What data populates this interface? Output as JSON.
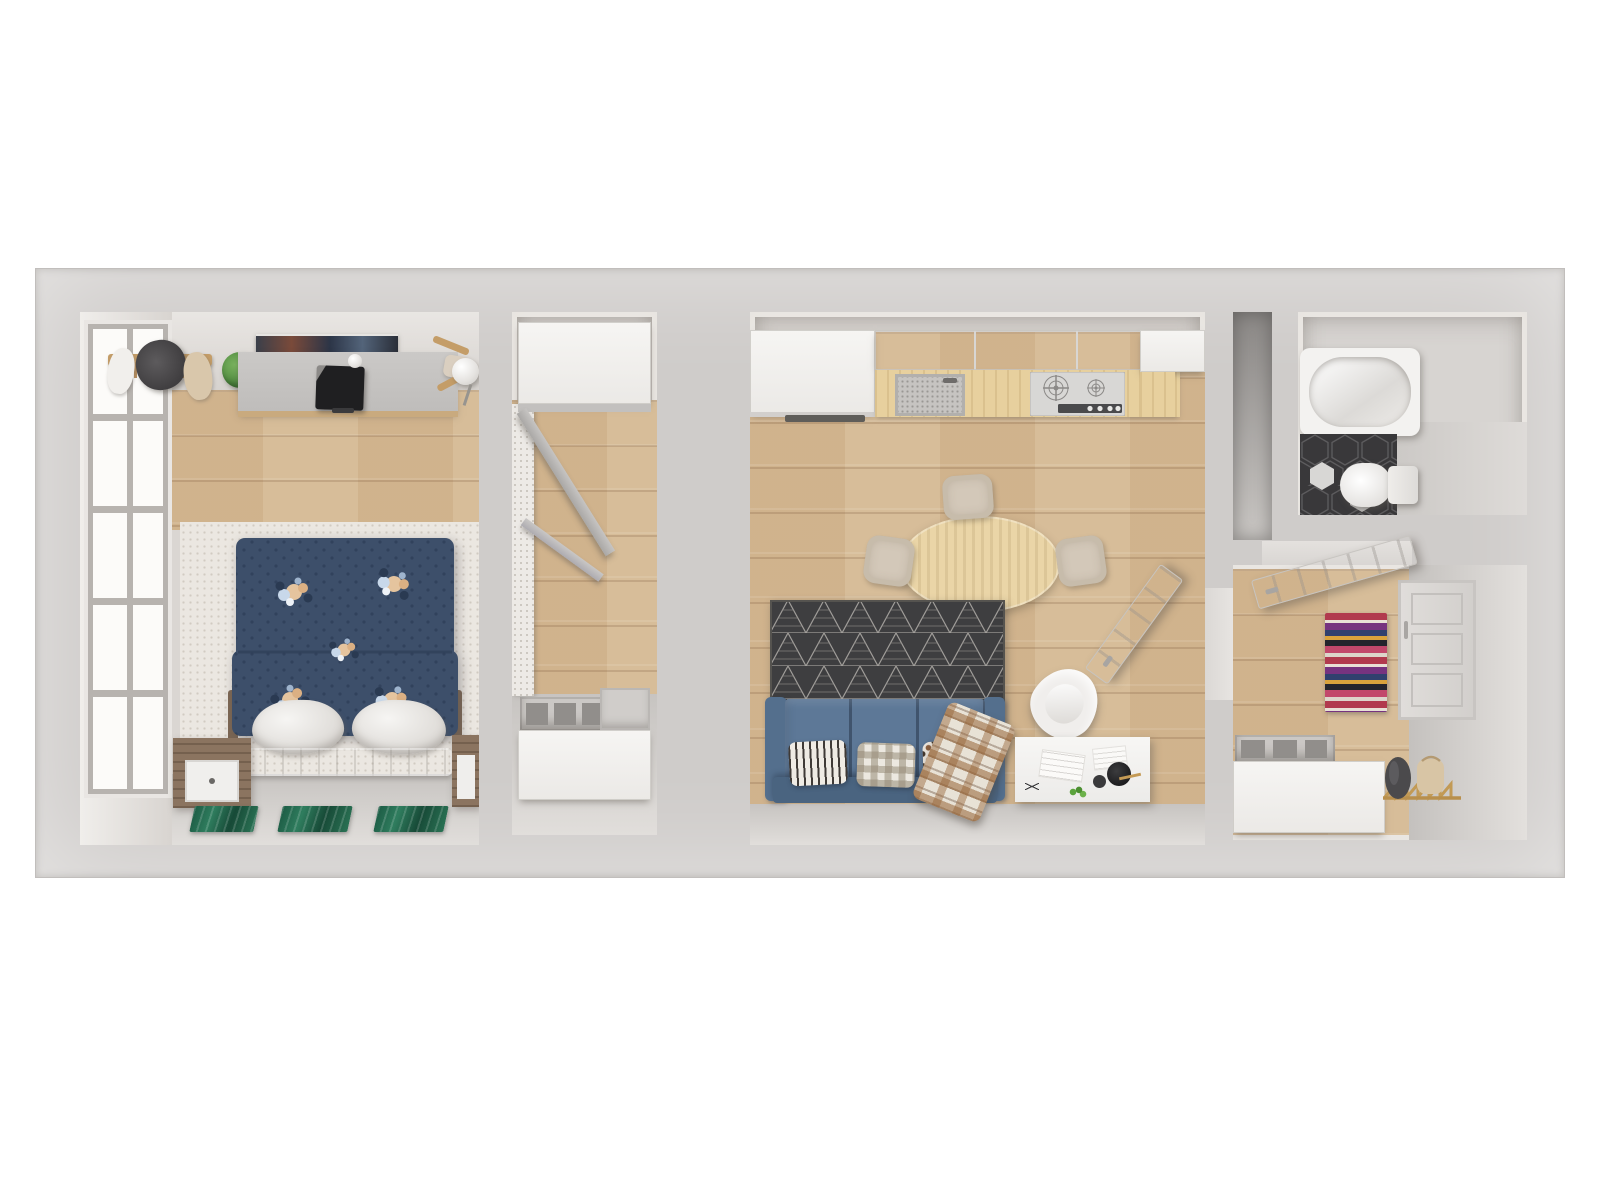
{
  "scene": {
    "description": "3D rendered top-down floor plan of a one-bedroom apartment on a white background",
    "view": "top-down architectural render, no text or UI controls visible",
    "background": "#ffffff"
  },
  "palette": {
    "canvas": "#ffffff",
    "wall": "#cfccca",
    "wallFace": "#e9e6e3",
    "wood": "#d5b993",
    "counterWood": "#e7d09e",
    "whiteRug": "#ebe7e1",
    "grayFloor": "#d2cfcc",
    "cabinet": "#f2f1ef",
    "sofa": "#5d7897",
    "sofaDark": "#4a6480",
    "duvet": "#3d4f6a",
    "rugDark": "#3e3e40",
    "table": "#ead5a7",
    "chair": "#d3c8b9",
    "tile": "#39383a",
    "tub": "#f3f2f0",
    "door": "#e9e7e4",
    "plant": "#5b9a4a",
    "matGreen": "#20654c",
    "rackGold": "#c29a55",
    "bagBeige": "#d8c5a5",
    "coatDark": "#4b4a4c",
    "lamp": "#232325",
    "shaft": "#8f8c8a"
  },
  "rooms": [
    {
      "id": "bedroom",
      "name": "Bedroom",
      "floor": "wood plank + white shag rug",
      "furniture": [
        "tall casement window",
        "wall clothes rack with hangers",
        "dark office chair",
        "potted plant",
        "gray desk with black monitor and white speaker ball",
        "dark wall art above desk",
        "white globe lamp",
        "wooden chair",
        "double bed with navy floral polka-dot duvet",
        "two white pillows",
        "white upholstered headboard bench",
        "wooden nightstand with white drawer",
        "three green malachite floor mats"
      ]
    },
    {
      "id": "closet",
      "name": "Walk-in closet",
      "floor": "wood plank",
      "furniture": [
        "upper white cabinet",
        "leaning gray drying rack boards",
        "white textured side shelf",
        "gray storage bins",
        "lower white cabinet"
      ]
    },
    {
      "id": "living-kitchen",
      "name": "Living room with kitchen",
      "floor": "wood plank",
      "furniture": [
        "tall white fridge cabinet",
        "white wall cabinets",
        "wood kitchen counter",
        "speckled sink with faucet",
        "stainless gas cooktop with four knobs",
        "oval light-wood dining table",
        "four beige dining chairs",
        "charcoal triangle-pattern area rug",
        "blue three-seat sofa",
        "striped pillow",
        "gingham pillow",
        "dotted pillow",
        "brown plaid throw blanket",
        "white molded armchair",
        "white desk with sketches, black lamp, gold pen and plant",
        "open white interior door"
      ]
    },
    {
      "id": "bathroom",
      "name": "Bathroom",
      "floor": "dark hexagon tile with two light hexagons",
      "furniture": [
        "white bathtub",
        "white toilet"
      ]
    },
    {
      "id": "entry",
      "name": "Entry hall",
      "floor": "wood plank",
      "furniture": [
        "open white interior door",
        "multicolor striped runner rug",
        "white paneled front door",
        "gray storage bins",
        "white shoe cabinet",
        "gold folding coat rack with dark coat and beige bag"
      ]
    }
  ]
}
